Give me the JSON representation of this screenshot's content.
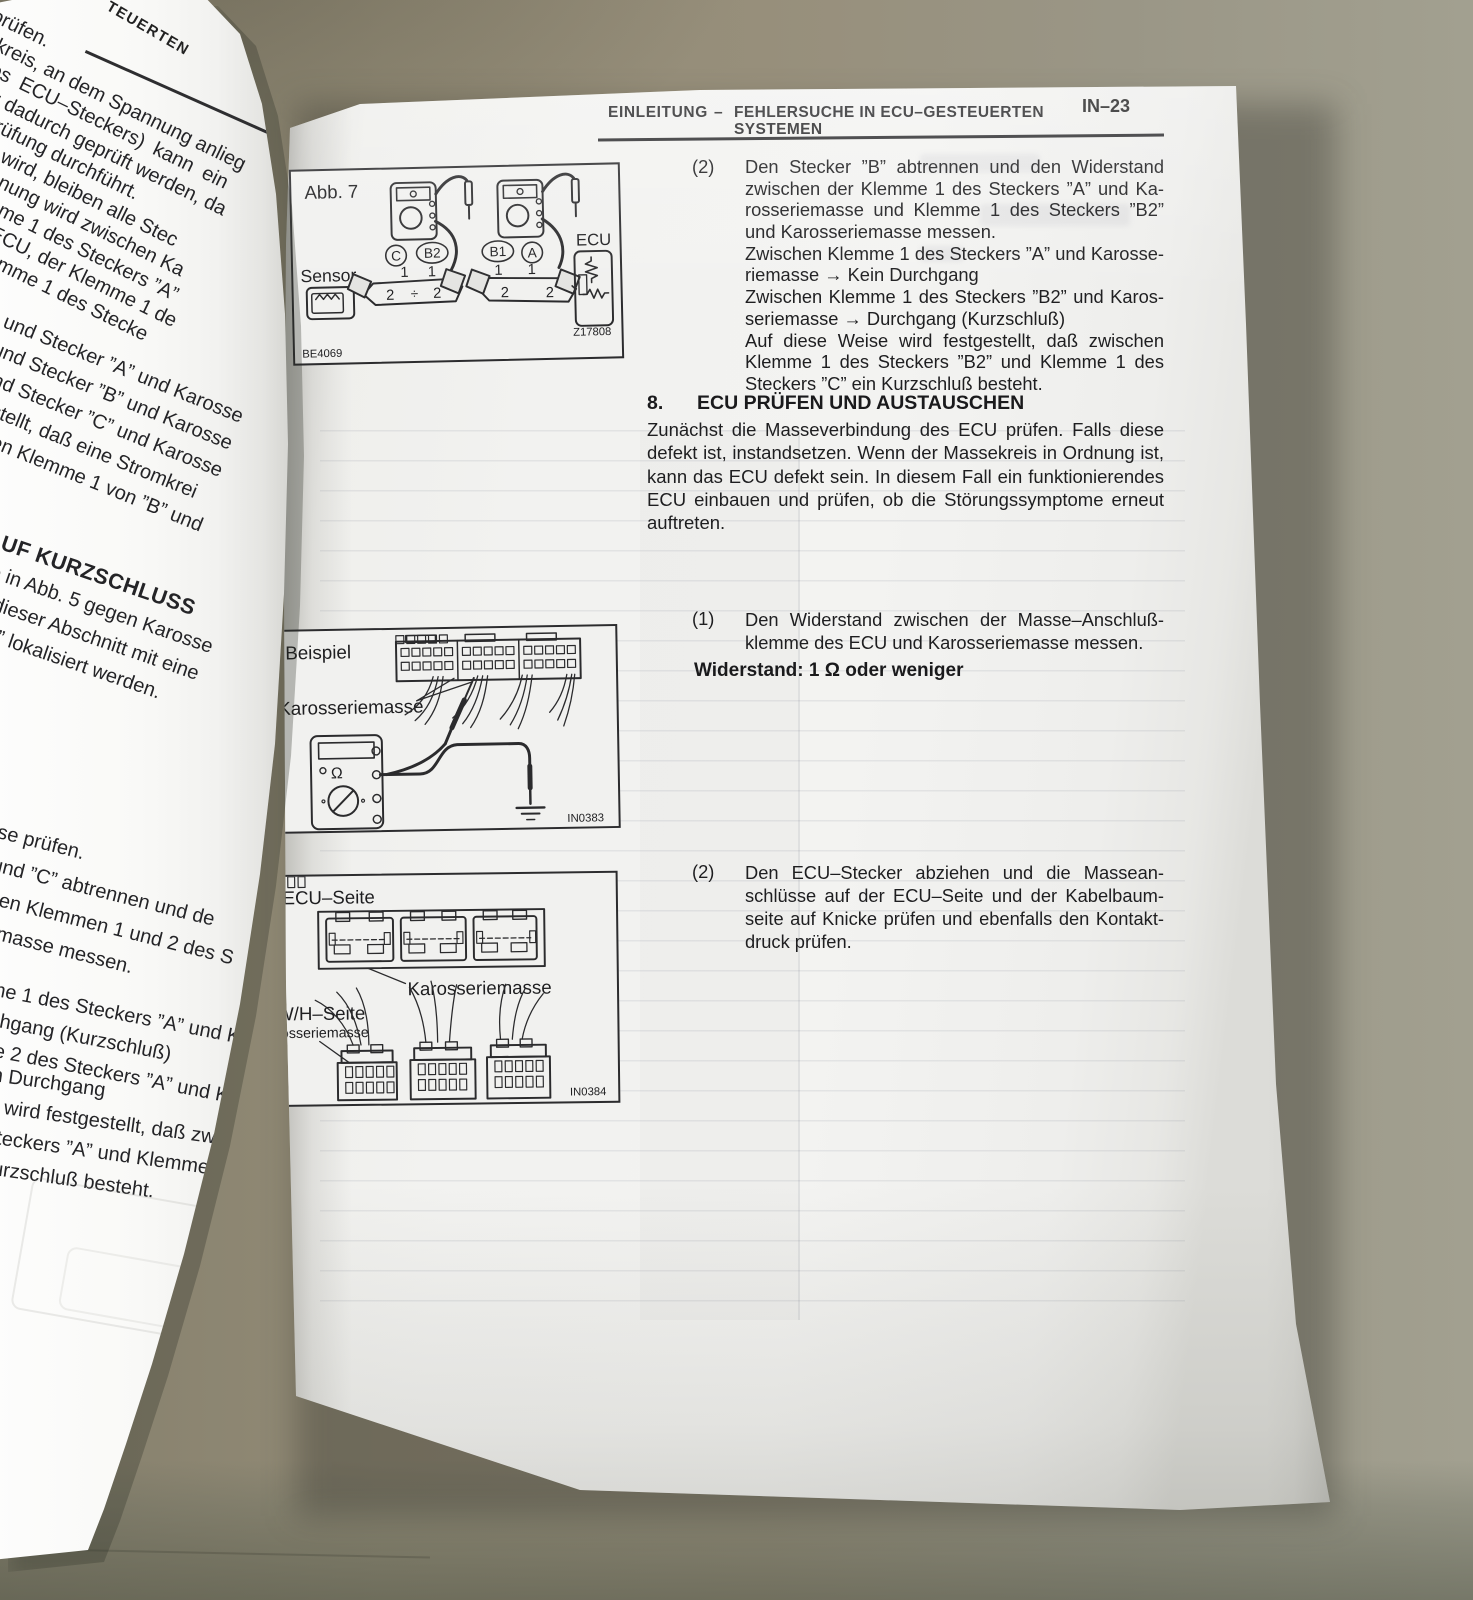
{
  "header": {
    "section": "EINLEITUNG",
    "separator": "–",
    "title_line1": "FEHLERSUCHE IN ECU–GESTEUERTEN",
    "title_line2": "SYSTEMEN",
    "page_number": "IN–23"
  },
  "left_page": {
    "header_fragment": "TEUERTEN",
    "block_a": {
      "lines": [
        "prüfen.",
        "mkreis, an dem Spannung anlieg",
        "  des  ECU–Steckers)  kann  ein",
        "nung dadurch geprüft werden, da",
        "überprüfung durchführt.",
        "gezeigt wird, bleiben alle Stec",
        "die Spannung wird zwischen Ka",
        "chlußklemme 1 des Steckers ”A”",
        "emmedes ECU, der Klemme 1 de",
        " Anschlußklemme 1 des Stecke",
        "ge gemessen.",
        "wie folgt sind:"
      ]
    },
    "block_b": {
      "lines": [
        "1 und Stecker ”A” und Karosse",
        "1 und Stecker ”B” und Karosse",
        "1 und Stecker ”C” und Karosse",
        "stgestellt, daß eine Stromkrei",
        "wischen Klemme 1 von ”B” und"
      ]
    },
    "block_c": {
      "heading": "AUF KURZSCHLUSS",
      "lines": [
        "vie in Abb. 5 gegen Karosse",
        "nn dieser Abschnitt mit eine",
        "asse” lokalisiert werden."
      ]
    },
    "block_d": {
      "lines": [
        "sse prüfen.",
        "” und ”C” abtrennen und de",
        "n den Klemmen 1 und 2 des S",
        "eriemasse messen."
      ]
    },
    "block_e": {
      "lines": [
        "me 1 des Steckers ”A” und Ka",
        "rchgang (Kurzschluß)",
        "me 2 des Steckers ”A” und K"
      ]
    },
    "block_f": {
      "lines": [
        "n Durchgang",
        "e wird festgestellt, daß zw",
        "Steckers ”A” und Klemme",
        "Kurzschluß besteht."
      ]
    }
  },
  "right_page": {
    "item2_top": {
      "num": "(2)",
      "p1": {
        "lines": [
          "Den Stecker ”B” abtrennen und den Widerstand",
          "zwischen der Klemme 1 des Steckers ”A” und Ka-",
          "rosseriemasse und Klemme 1 des Steckers ”B2”",
          "und Karosseriemasse messen."
        ]
      },
      "p2": {
        "lines": [
          "Zwischen Klemme 1 des Steckers ”A” und Karosse-",
          "riemasse → Kein Durchgang"
        ]
      },
      "p3": {
        "lines": [
          "Zwischen Klemme 1 des Steckers ”B2” und Karos-",
          "seriemasse → Durchgang (Kurzschluß)"
        ]
      },
      "p4": {
        "lines": [
          "Auf diese Weise wird festgestellt, daß zwischen",
          "Klemme 1 des Steckers ”B2” und Klemme 1 des",
          "Steckers ”C” ein Kurzschluß besteht."
        ]
      }
    },
    "section8": {
      "num": "8.",
      "title": "ECU PRÜFEN UND AUSTAUSCHEN",
      "body": "Zunächst die Masseverbindung des ECU prüfen. Falls diese defekt ist, instandsetzen. Wenn der Massekreis in Ordnung ist, kann das ECU defekt sein. In diesem Fall ein funktionierendes ECU einbauen und prüfen, ob die Störungssymptome erneut auftreten."
    },
    "item1": {
      "num": "(1)",
      "lines": [
        "Den Widerstand zwischen der Masse–Anschluß-",
        "klemme des ECU und Karosseriemasse messen."
      ],
      "spec": "Widerstand: 1 Ω oder weniger"
    },
    "item2_bottom": {
      "num": "(2)",
      "lines": [
        "Den ECU–Stecker abziehen und die Massean-",
        "schlüsse auf der ECU–Seite und der Kabelbaum-",
        "seite auf Knicke prüfen und ebenfalls den Kontakt-",
        "druck prüfen."
      ]
    },
    "fig1": {
      "caption": "Abb. 7",
      "sensor_label": "Sensor",
      "conn_c": "C",
      "conn_b2": "B2",
      "conn_b1": "B1",
      "conn_a": "A",
      "ecu_label": "ECU",
      "pin1": "1",
      "pin2": "2",
      "divider": "÷",
      "code_left": "BE4069",
      "code_right": "Z17808"
    },
    "fig2": {
      "caption": "Beispiel",
      "ground_label": "Karosseriemasse",
      "ohm": "Ω",
      "code": "IN0383"
    },
    "fig3": {
      "caption": "ECU–Seite",
      "ecu_ground_label": "Karosseriemasse",
      "wh_caption": "W/H–Seite",
      "wh_ground_label": "Karosseriemasse",
      "code": "IN0384"
    }
  }
}
